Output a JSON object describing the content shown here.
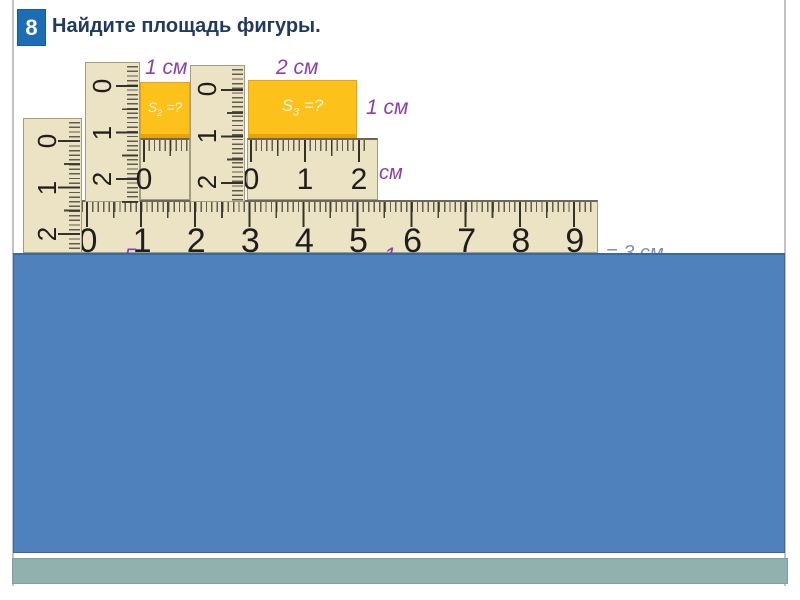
{
  "header": {
    "number": "8",
    "title": "Найдите площадь фигуры."
  },
  "annotations": {
    "s2_top": "1 см",
    "s3_top": "2 см",
    "s3_right": "1 см",
    "mini_unit": "см",
    "s2_label": {
      "base": "S",
      "sub": "2",
      "rest": " =?"
    },
    "s3_label": {
      "base": "S",
      "sub": "3",
      "rest": " =?"
    },
    "fragments": [
      {
        "text": "5"
      },
      {
        "text": "1"
      },
      {
        "text": "= 3 см"
      }
    ]
  },
  "rulers": {
    "v1": {
      "labels": [
        "0",
        "1",
        "2"
      ]
    },
    "v2": {
      "labels": [
        "0",
        "1",
        "2"
      ]
    },
    "v3": {
      "labels": [
        "0",
        "1",
        "2"
      ]
    },
    "h2": {
      "labels": [
        "0"
      ]
    },
    "h3": {
      "labels": [
        "0",
        "1",
        "2"
      ]
    },
    "hbig": {
      "labels": [
        "0",
        "1",
        "2",
        "3",
        "4",
        "5",
        "6",
        "7",
        "8",
        "9"
      ]
    }
  },
  "colors": {
    "accent_blue": "#4f81bd",
    "ruler_beige": "#ece3c5",
    "highlight_yellow": "#fdc11c",
    "label_purple": "#8b3fa8",
    "header_navy": "#203a60",
    "number_box_blue": "#1d6db5",
    "footer_teal": "#91b1ae"
  }
}
